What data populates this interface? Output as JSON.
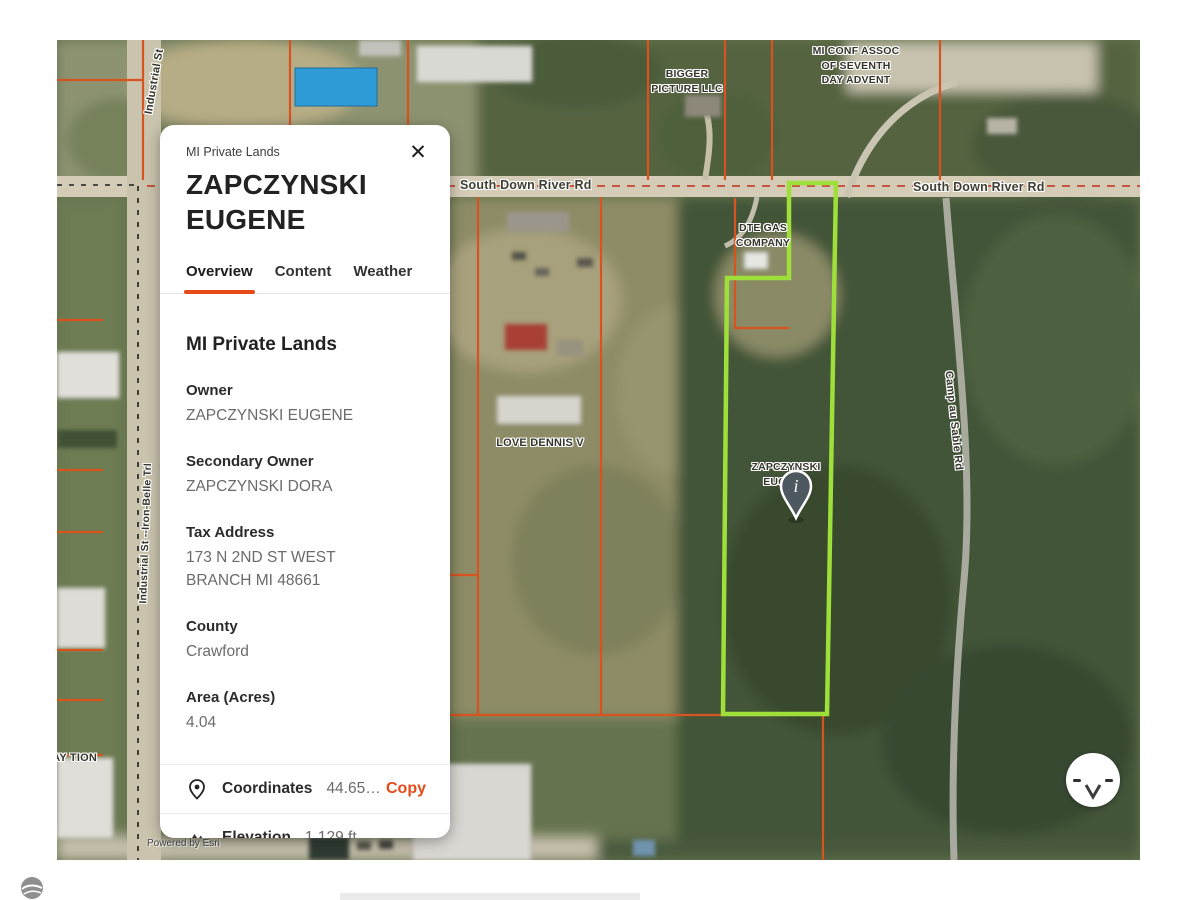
{
  "colors": {
    "accent": "#e64a19",
    "parcel_line": "#d9531e",
    "selected_parcel_outline": "#9ee039"
  },
  "map": {
    "road_label_left": "South Down River Rd",
    "road_label_right": "South Down River Rd",
    "industrial_st_label": "Industrial St",
    "iron_belle_label": "Industrial St --Iron-Belle Trl",
    "camp_au_sable_label": "Camp au Sable Rd",
    "parcel_labels": {
      "bigger_picture": "BIGGER PICTURE LLC",
      "mi_conf": "MI CONF ASSOC OF SEVENTH DAY ADVENT",
      "dte_gas": "DTE GAS COMPANY",
      "love_dennis": "LOVE DENNIS V",
      "zapczynski": "ZAPCZYNSKI EUGENE",
      "left_edge_partial": "AY TION"
    },
    "marker_glyph": "i",
    "attribution": "Powered by Esri"
  },
  "card": {
    "source_label": "MI Private Lands",
    "title": "ZAPCZYNSKI EUGENE",
    "close_glyph": "✕",
    "tabs": [
      {
        "label": "Overview",
        "active": true
      },
      {
        "label": "Content",
        "active": false
      },
      {
        "label": "Weather",
        "active": false
      }
    ],
    "section_title": "MI Private Lands",
    "fields": [
      {
        "label": "Owner",
        "value": "ZAPCZYNSKI EUGENE"
      },
      {
        "label": "Secondary Owner",
        "value": "ZAPCZYNSKI DORA"
      },
      {
        "label": "Tax Address",
        "value": "173 N 2ND ST WEST BRANCH MI 48661"
      },
      {
        "label": "County",
        "value": "Crawford"
      },
      {
        "label": "Area (Acres)",
        "value": "4.04"
      }
    ],
    "coordinates_row": {
      "label": "Coordinates",
      "value": "44.65…",
      "action": "Copy"
    },
    "elevation_row": {
      "label": "Elevation",
      "value": "1,129 ft"
    }
  }
}
